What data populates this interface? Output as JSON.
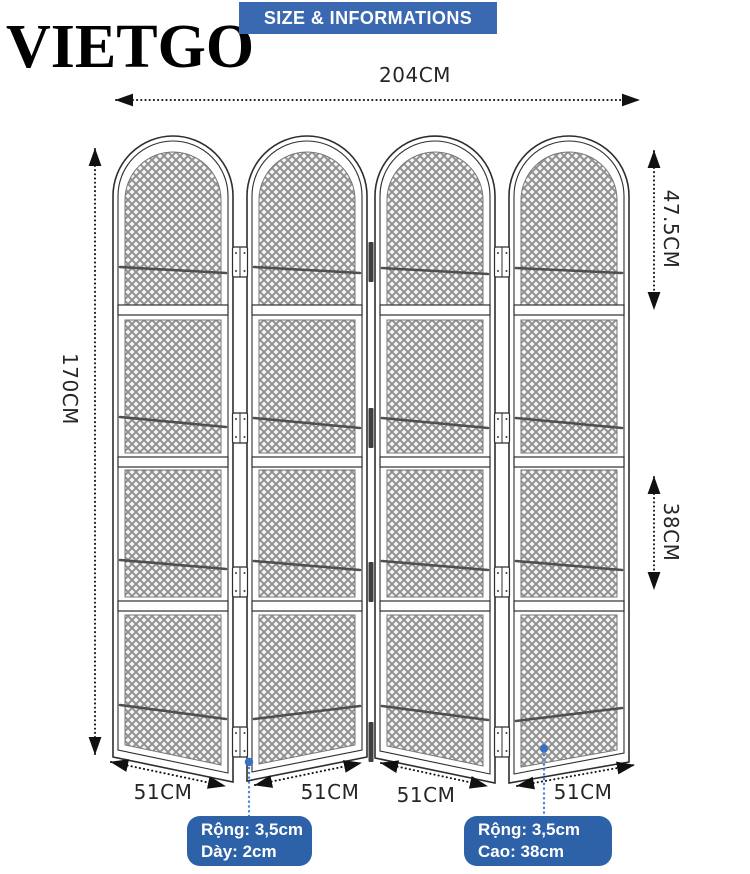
{
  "brand": "VIETGO",
  "banner": {
    "title": "SIZE & INFORMATIONS",
    "bg_color": "#3a69b2",
    "text_color": "#ffffff"
  },
  "dimensions": {
    "overall_width": "204CM",
    "overall_height": "170CM",
    "arch_section_height": "47.5CM",
    "lower_section_height": "38CM",
    "panel_width_1": "51CM",
    "panel_width_2": "51CM",
    "panel_width_3": "51CM",
    "panel_width_4": "51CM"
  },
  "callouts": {
    "left": {
      "line1": "Rộng: 3,5cm",
      "line2": "Dày: 2cm"
    },
    "right": {
      "line1": "Rộng: 3,5cm",
      "line2": "Cao: 38cm"
    }
  },
  "colors": {
    "callout_bg": "#2d62a8",
    "leader_line": "#4a84d6",
    "line_art": "#2e2e2e",
    "mesh_line": "#909090",
    "rod": "#4f4f4f",
    "dim_text": "#262626"
  }
}
